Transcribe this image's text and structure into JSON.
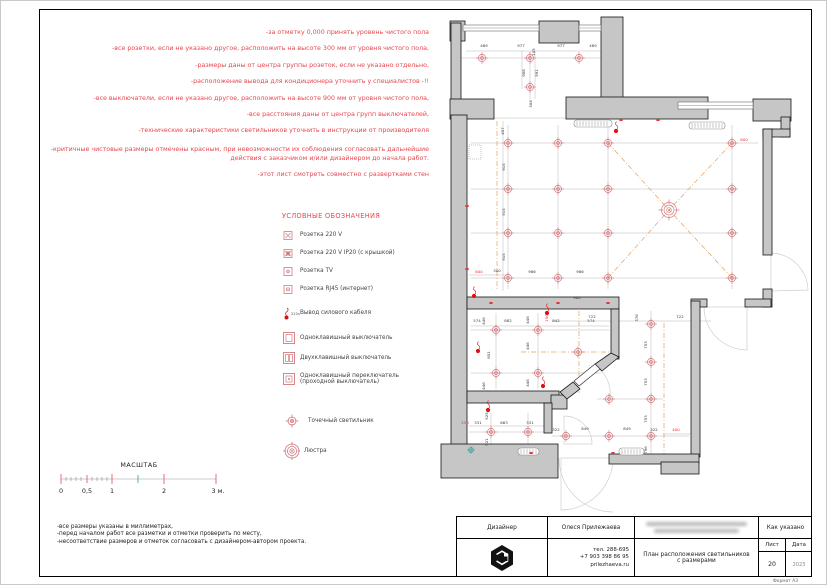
{
  "page": {
    "format_label": "Формат А3"
  },
  "notes_red": [
    "-за отметку 0,000 принять уровень чистого пола",
    "-все розетки, если не указано другое, расположить на высоте 300 мм от уровня чистого пола,",
    "-размеры даны от центра группы розеток, если не указано отдельно,",
    "-расположение вывода для кондиционера уточнить у специалистов -!!",
    "-все выключатели, если не указано другое, расположить на высоте 900 мм от уровня чистого пола,",
    "-все расстояния даны от центра групп выключателей,",
    "-технические характеристики светильников уточнить в инструкции от производителя",
    "-критичные чистовые размеры отмечены красным, при невозможности их соблюдения согласовать дальнейшие действия с заказчиком и/или дизайнером до начала работ.",
    "-этот лист смотреть совместно с развертками стен"
  ],
  "legend": {
    "title": "УСЛОВНЫЕ ОБОЗНАЧЕНИЯ",
    "items": [
      {
        "icon": "socket-220v-icon",
        "label": "Розетка  220 V"
      },
      {
        "icon": "socket-ip20-icon",
        "label": "Розетка  220 V IP20 (с крышкой)"
      },
      {
        "icon": "socket-tv-icon",
        "label": "Розетка  TV"
      },
      {
        "icon": "socket-rj45-icon",
        "label": "Розетка  RJ45 (интернет)"
      },
      {
        "icon": "power-cable-icon",
        "label": "Вывод силового кабеля",
        "sub": "220v"
      },
      {
        "icon": "switch-1gang-icon",
        "label": "Одноклавишный выключатель"
      },
      {
        "icon": "switch-2gang-icon",
        "label": "Двухклавишный выключатель"
      },
      {
        "icon": "switch-pass-icon",
        "label": "Одноклавишный переключатель (проходной выключатель)"
      },
      {
        "icon": "spotlight-icon",
        "label": "Точечный светильник"
      },
      {
        "icon": "chandelier-icon",
        "label": "Люстра"
      }
    ]
  },
  "scale": {
    "title": "МАСШТАБ",
    "labels": [
      "0",
      "0,5",
      "1",
      "2",
      "3 м."
    ]
  },
  "notes_black": [
    "-все размеры указаны в миллиметрах,",
    "-перед началом работ все разметки и отметки проверить по месту,",
    "-несоответствие размеров и отметок согласовать с дизайнером-автором проекта."
  ],
  "title_block": {
    "designer_label": "Дизайнер",
    "designer_name": "Олеся Прилежаева",
    "contacts": [
      "тел. 288-695",
      "+7 903 398 86 95",
      "prilezhaeva.ru"
    ],
    "drawing_title": "План расположения светильников с размерами",
    "scale_value": "Как указано",
    "sheet_label": "Лист",
    "date_label": "Дата",
    "sheet_value": "20",
    "date_value": "2023"
  },
  "floorplan": {
    "chains": [
      [
        465,
        50,
        600,
        50
      ],
      [
        460,
        57,
        600,
        57
      ],
      [
        529,
        50,
        529,
        100
      ],
      [
        521,
        50,
        521,
        88
      ],
      [
        534,
        50,
        534,
        98
      ],
      [
        493,
        117,
        565,
        117
      ],
      [
        470,
        142,
        757,
        142
      ],
      [
        470,
        188,
        735,
        188
      ],
      [
        470,
        232,
        735,
        232
      ],
      [
        470,
        277,
        735,
        277
      ],
      [
        507,
        124,
        507,
        288
      ],
      [
        557,
        124,
        557,
        288
      ],
      [
        607,
        124,
        607,
        288
      ],
      [
        731,
        124,
        731,
        288
      ],
      [
        502,
        120,
        502,
        290
      ],
      [
        468,
        274,
        507,
        274
      ],
      [
        522,
        301,
        606,
        301
      ],
      [
        470,
        325,
        608,
        325
      ],
      [
        470,
        329,
        608,
        329
      ],
      [
        470,
        372,
        600,
        372
      ],
      [
        495,
        312,
        495,
        388
      ],
      [
        537,
        312,
        537,
        388
      ],
      [
        468,
        425,
        545,
        425
      ],
      [
        468,
        431,
        545,
        431
      ],
      [
        490,
        412,
        490,
        450
      ],
      [
        527,
        412,
        527,
        450
      ],
      [
        551,
        320,
        710,
        320
      ],
      [
        650,
        310,
        650,
        453
      ],
      [
        551,
        435,
        688,
        435
      ],
      [
        596,
        398,
        662,
        398
      ],
      [
        662,
        433,
        697,
        433
      ]
    ],
    "axes": [
      [
        496,
        120,
        496,
        290
      ],
      [
        578,
        310,
        578,
        392
      ],
      [
        663,
        322,
        663,
        462
      ],
      [
        520,
        351,
        610,
        351
      ]
    ],
    "diagonals": [
      [
        607,
        142,
        668,
        209
      ],
      [
        731,
        142,
        668,
        209
      ],
      [
        607,
        277,
        668,
        209
      ],
      [
        731,
        277,
        668,
        209
      ]
    ],
    "walls": [
      [
        449,
        20,
        15,
        20
      ],
      [
        450,
        22,
        10,
        80
      ],
      [
        538,
        20,
        40,
        22
      ],
      [
        600,
        16,
        22,
        84
      ],
      [
        565,
        96,
        142,
        22
      ],
      [
        449,
        98,
        44,
        20
      ],
      [
        450,
        114,
        16,
        352
      ],
      [
        752,
        98,
        38,
        22
      ],
      [
        780,
        116,
        9,
        20
      ],
      [
        762,
        128,
        27,
        8
      ],
      [
        762,
        128,
        9,
        126
      ],
      [
        762,
        288,
        9,
        18
      ],
      [
        690,
        298,
        16,
        8
      ],
      [
        744,
        298,
        26,
        8
      ],
      [
        690,
        300,
        9,
        156
      ],
      [
        466,
        296,
        152,
        12
      ],
      [
        610,
        308,
        8,
        50
      ],
      [
        466,
        390,
        92,
        12
      ],
      [
        550,
        394,
        16,
        14
      ],
      [
        543,
        402,
        8,
        30
      ],
      [
        440,
        443,
        117,
        34
      ],
      [
        608,
        453,
        90,
        10
      ],
      [
        660,
        461,
        38,
        12
      ]
    ],
    "wall_polys": [
      "610,352 618,356 601,370 594,363",
      "572,381 579,388 566,398 559,391"
    ],
    "leafs": [
      "594,363 599,368 578,385 573,380"
    ],
    "windows": [
      [
        462,
        24,
        76,
        6
      ],
      [
        578,
        24,
        22,
        6
      ],
      [
        677,
        101,
        75,
        7
      ]
    ],
    "radiators": [
      [
        573,
        119,
        38,
        7
      ],
      [
        688,
        121,
        36,
        7
      ],
      [
        517,
        447,
        21,
        7
      ],
      [
        618,
        447,
        25,
        7
      ]
    ],
    "doors": [
      "M770,252 A38,38 0 0 1 807,289 L770,290 L770,252",
      "M703,306 A43,43 0 0 0 746,349 L746,306 L703,306",
      "M563,415 A28,28 0 0 1 591,443 L563,443 L563,415",
      "M596,366 A33,33 0 0 1 609,396",
      "M612,457 A52,52 0 0 1 560,509 L560,457 L612,457",
      "M558,457 A54,54 0 0 0 612,511"
    ],
    "spotlights": [
      [
        481,
        57
      ],
      [
        529,
        57
      ],
      [
        578,
        57
      ],
      [
        529,
        86
      ],
      [
        507,
        142
      ],
      [
        557,
        142
      ],
      [
        607,
        142
      ],
      [
        731,
        142
      ],
      [
        507,
        188
      ],
      [
        557,
        188
      ],
      [
        607,
        188
      ],
      [
        731,
        188
      ],
      [
        507,
        232
      ],
      [
        557,
        232
      ],
      [
        607,
        232
      ],
      [
        731,
        232
      ],
      [
        507,
        277
      ],
      [
        557,
        277
      ],
      [
        607,
        277
      ],
      [
        731,
        277
      ],
      [
        495,
        329
      ],
      [
        537,
        329
      ],
      [
        495,
        372
      ],
      [
        537,
        372
      ],
      [
        577,
        351
      ],
      [
        490,
        431
      ],
      [
        527,
        431
      ],
      [
        650,
        323
      ],
      [
        650,
        361
      ],
      [
        650,
        398
      ],
      [
        650,
        435
      ],
      [
        608,
        398
      ],
      [
        565,
        435
      ],
      [
        608,
        435
      ]
    ],
    "chandelier": {
      "x": 668,
      "y": 209
    },
    "dim_labels": [
      [
        "489",
        483,
        46,
        0
      ],
      [
        "977",
        520,
        46,
        0
      ],
      [
        "105",
        534,
        51,
        -90
      ],
      [
        "977",
        560,
        46,
        0
      ],
      [
        "489",
        592,
        46,
        0
      ],
      [
        "908",
        524,
        72,
        -90
      ],
      [
        "591",
        537,
        72,
        -90
      ],
      [
        "304",
        531,
        103,
        -90
      ],
      [
        "457",
        503,
        130,
        -90
      ],
      [
        "915",
        504,
        166,
        -90
      ],
      [
        "915",
        504,
        211,
        -90
      ],
      [
        "915",
        504,
        256,
        -90
      ],
      [
        "600",
        478,
        272,
        0,
        "r"
      ],
      [
        "300",
        496,
        271,
        0
      ],
      [
        "986",
        531,
        272,
        0
      ],
      [
        "986",
        579,
        272,
        0
      ],
      [
        "600",
        743,
        140,
        0,
        "r"
      ],
      [
        "900",
        576,
        298,
        0
      ],
      [
        "574",
        476,
        321,
        0
      ],
      [
        "882",
        507,
        321,
        0
      ],
      [
        "842",
        555,
        321,
        0
      ],
      [
        "574",
        590,
        321,
        0
      ],
      [
        "446",
        484,
        320,
        -90
      ],
      [
        "851",
        489,
        354,
        -90
      ],
      [
        "446",
        484,
        385,
        -90
      ],
      [
        "446",
        528,
        319,
        -90
      ],
      [
        "446",
        528,
        345,
        -90
      ],
      [
        "446",
        528,
        382,
        -90
      ],
      [
        "150",
        547,
        317,
        -90,
        "r"
      ],
      [
        "250",
        464,
        423,
        0,
        "r"
      ],
      [
        "331",
        477,
        423,
        0
      ],
      [
        "663",
        503,
        423,
        0
      ],
      [
        "331",
        529,
        423,
        0
      ],
      [
        "525",
        487,
        415,
        -90
      ],
      [
        "521",
        487,
        441,
        -90
      ],
      [
        "722",
        591,
        317,
        0
      ],
      [
        "376",
        637,
        317,
        -90
      ],
      [
        "722",
        679,
        317,
        0
      ],
      [
        "753",
        646,
        344,
        -90
      ],
      [
        "753",
        646,
        381,
        -90
      ],
      [
        "753",
        646,
        418,
        -90
      ],
      [
        "322",
        555,
        430,
        0
      ],
      [
        "849",
        584,
        429,
        0
      ],
      [
        "849",
        626,
        429,
        0
      ],
      [
        "322",
        653,
        430,
        0
      ],
      [
        "400",
        675,
        430,
        0,
        "r"
      ],
      [
        "796",
        646,
        449,
        -90
      ]
    ],
    "cable_outlets": [
      [
        615,
        130
      ],
      [
        546,
        312
      ],
      [
        477,
        350
      ],
      [
        473,
        295
      ],
      [
        542,
        385
      ],
      [
        487,
        409
      ]
    ],
    "wall_ticks": [
      [
        466,
        205
      ],
      [
        466,
        268
      ],
      [
        620,
        119
      ],
      [
        657,
        119
      ],
      [
        490,
        302
      ],
      [
        557,
        302
      ],
      [
        607,
        302
      ],
      [
        612,
        452
      ],
      [
        530,
        452
      ]
    ],
    "teal_marks": [
      [
        470,
        449
      ]
    ],
    "panels": [
      [
        468,
        144,
        12,
        14
      ]
    ]
  }
}
